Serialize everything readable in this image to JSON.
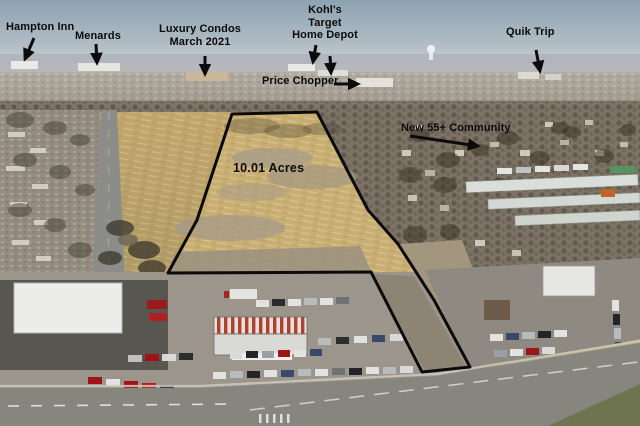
{
  "photo": {
    "type": "aerial-listing-photo",
    "acreage_label": "10.01 Acres"
  },
  "labels": {
    "hampton_inn": "Hampton Inn",
    "menards": "Menards",
    "luxury_condos": "Luxury Condos\nMarch 2021",
    "kohls_target_home_depot": "Kohl's\nTarget\nHome Depot",
    "price_chopper": "Price Chopper",
    "quik_trip": "Quik Trip",
    "new_community": "New 55+ Community"
  },
  "colors": {
    "annotation": "#0b0b0b",
    "sky": "#8da2b0",
    "field": "#c7ad72",
    "pavement": "#9b958c"
  }
}
